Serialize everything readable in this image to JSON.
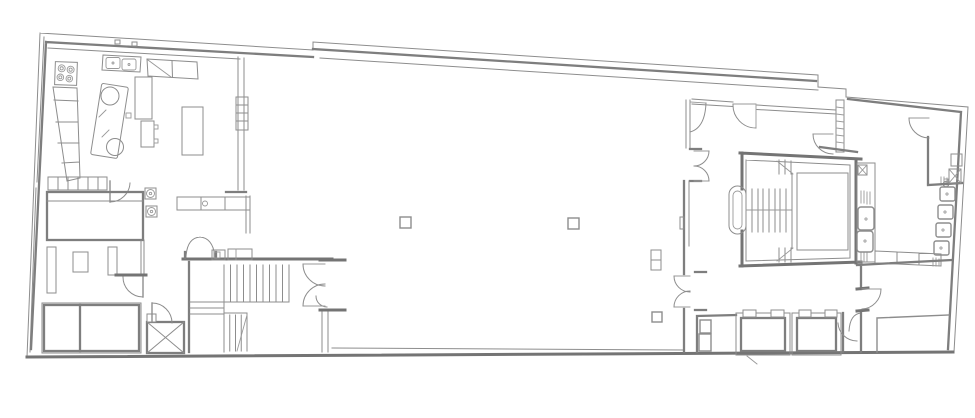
{
  "canvas": {
    "width": 975,
    "height": 418
  },
  "colors": {
    "background": "#ffffff",
    "line": "#8d8d8d",
    "wall": "#7e7e7e",
    "heavy": "#747474",
    "furniture": "#999999"
  },
  "plan": {
    "type": "architectural-floor-plan",
    "text_labels_present": false,
    "features": {
      "building-outline": "elongated skewed footprint, stepped north wall, slanted west and east walls",
      "kitchen": "north-west corner room: 4-burner range, angled base cabinet run, double-sink counter, wall cabinets, tall units, tilted island with two round fixtures, prep table, radiator niche wall",
      "side-room": "room below kitchen with shelf row, swing door, large rectangular table, two round floor fixtures, wall stubs",
      "storage-room": "south-west corner: large divided storage table, X-marked service shaft, swing doors",
      "service-staircase": "U-return stair with straight flights, landing steps and break line",
      "main-hall": "large open hall with two square columns, small column and radiator near east wall",
      "hall-west-double-door": "double swing door in west wall of hall",
      "hall-east-wall": "east wall of hall with single and double swing doors and pilaster",
      "lobby": "entrance lobby corridor with duct hatch strip and swing doors",
      "grand-staircase": "imperial stair with curved newel, central flight, open well and return flights",
      "washroom": "wash room along east wall: basin rows, faucet, benches, cabinet strip with X-shaft",
      "toilet-room": "small north-east room with door, cistern box and X-marked shaft",
      "elevator-shafts": "two thick-walled elevator shafts with door jambs",
      "elevator-lobby": "small lobby with two cabinets left of shafts",
      "south-east-room": "corner room with swing doors and L-partition closet"
    }
  }
}
